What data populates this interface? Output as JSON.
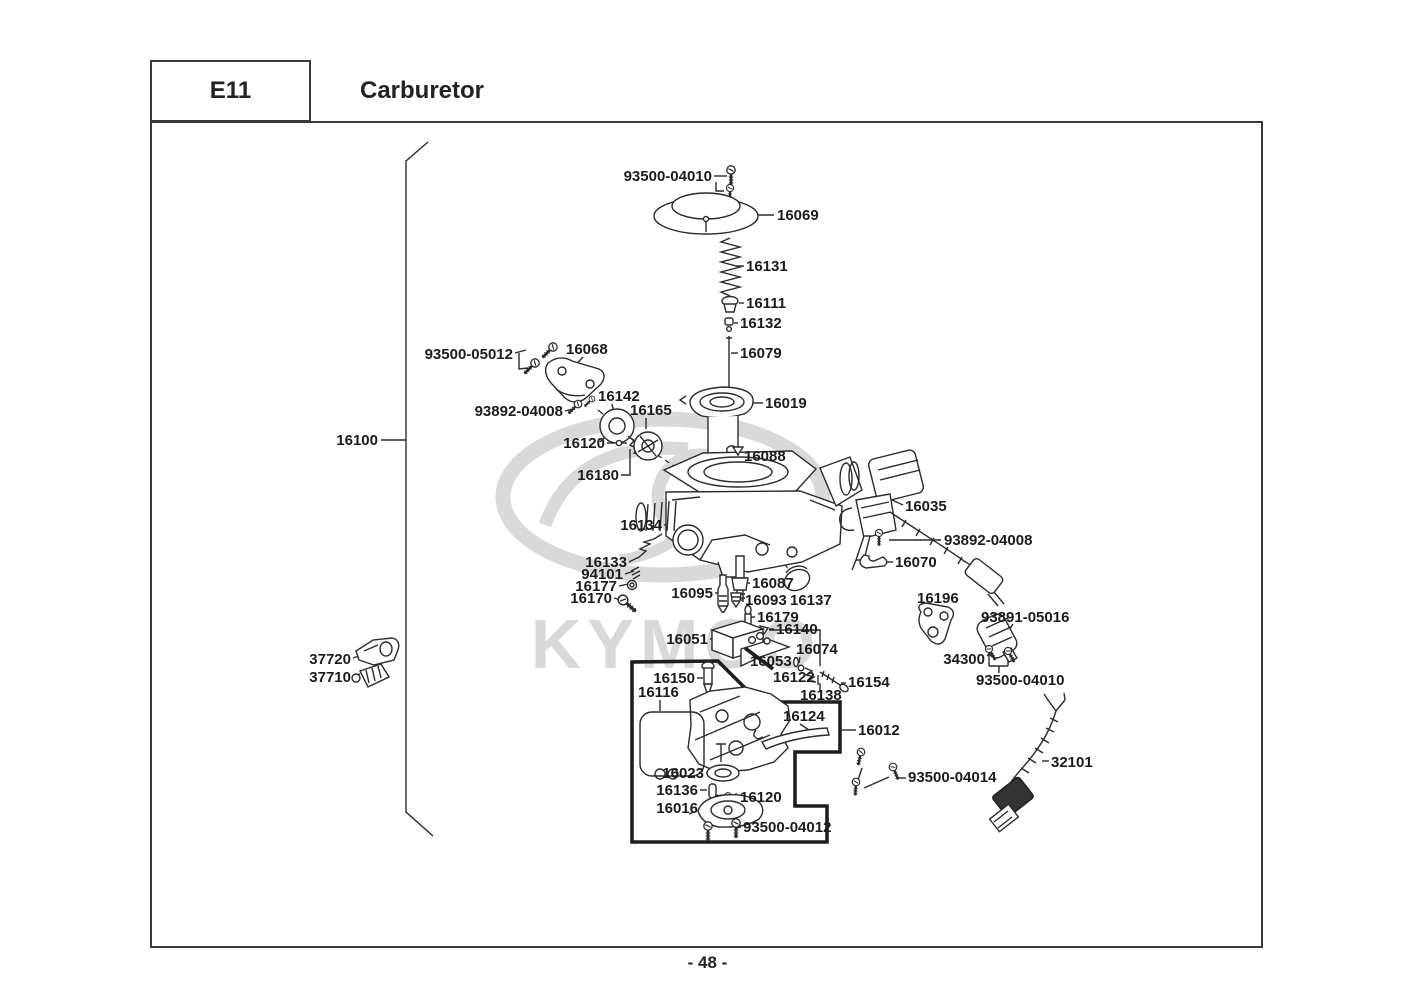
{
  "header": {
    "code": "E11",
    "title": "Carburetor"
  },
  "page_number": "- 48 -",
  "watermark": {
    "brand": "KYMCO"
  },
  "diagram": {
    "assembly_ref": "16100",
    "labels": [
      {
        "id": "93500-04010-top",
        "text": "93500-04010",
        "x": 712,
        "y": 181,
        "anchor": "end"
      },
      {
        "id": "16069",
        "text": "16069",
        "x": 777,
        "y": 220,
        "anchor": "start"
      },
      {
        "id": "16131",
        "text": "16131",
        "x": 746,
        "y": 271,
        "anchor": "start"
      },
      {
        "id": "16111",
        "text": "16111",
        "x": 746,
        "y": 308,
        "anchor": "start"
      },
      {
        "id": "16132",
        "text": "16132",
        "x": 740,
        "y": 328,
        "anchor": "start"
      },
      {
        "id": "16079",
        "text": "16079",
        "x": 740,
        "y": 358,
        "anchor": "start"
      },
      {
        "id": "93500-05012",
        "text": "93500-05012",
        "x": 513,
        "y": 359,
        "anchor": "end"
      },
      {
        "id": "16068",
        "text": "16068",
        "x": 566,
        "y": 354,
        "anchor": "start"
      },
      {
        "id": "16142",
        "text": "16142",
        "x": 598,
        "y": 401,
        "anchor": "start"
      },
      {
        "id": "93892-04008-left",
        "text": "93892-04008",
        "x": 563,
        "y": 416,
        "anchor": "end"
      },
      {
        "id": "16165",
        "text": "16165",
        "x": 630,
        "y": 415,
        "anchor": "start"
      },
      {
        "id": "16120-top",
        "text": "16120",
        "x": 605,
        "y": 448,
        "anchor": "end"
      },
      {
        "id": "16180",
        "text": "16180",
        "x": 619,
        "y": 480,
        "anchor": "end"
      },
      {
        "id": "16019",
        "text": "16019",
        "x": 765,
        "y": 408,
        "anchor": "start"
      },
      {
        "id": "16088",
        "text": "16088",
        "x": 744,
        "y": 461,
        "anchor": "start"
      },
      {
        "id": "16134",
        "text": "16134",
        "x": 662,
        "y": 530,
        "anchor": "end"
      },
      {
        "id": "16035",
        "text": "16035",
        "x": 905,
        "y": 511,
        "anchor": "start"
      },
      {
        "id": "93892-04008-right",
        "text": "93892-04008",
        "x": 944,
        "y": 545,
        "anchor": "start"
      },
      {
        "id": "16070",
        "text": "16070",
        "x": 895,
        "y": 567,
        "anchor": "start"
      },
      {
        "id": "16133",
        "text": "16133",
        "x": 627,
        "y": 567,
        "anchor": "end"
      },
      {
        "id": "94101",
        "text": "94101",
        "x": 623,
        "y": 579,
        "anchor": "end"
      },
      {
        "id": "16177",
        "text": "16177",
        "x": 617,
        "y": 591,
        "anchor": "end"
      },
      {
        "id": "16170",
        "text": "16170",
        "x": 612,
        "y": 603,
        "anchor": "end"
      },
      {
        "id": "16095",
        "text": "16095",
        "x": 713,
        "y": 598,
        "anchor": "end"
      },
      {
        "id": "16087",
        "text": "16087",
        "x": 752,
        "y": 588,
        "anchor": "start"
      },
      {
        "id": "16093",
        "text": "16093",
        "x": 745,
        "y": 605,
        "anchor": "start"
      },
      {
        "id": "16137",
        "text": "16137",
        "x": 790,
        "y": 605,
        "anchor": "start"
      },
      {
        "id": "16179",
        "text": "16179",
        "x": 757,
        "y": 622,
        "anchor": "start"
      },
      {
        "id": "16140",
        "text": "16140",
        "x": 776,
        "y": 634,
        "anchor": "start"
      },
      {
        "id": "16051",
        "text": "16051",
        "x": 708,
        "y": 644,
        "anchor": "end"
      },
      {
        "id": "16074",
        "text": "16074",
        "x": 796,
        "y": 654,
        "anchor": "start"
      },
      {
        "id": "16053",
        "text": "16053",
        "x": 750,
        "y": 666,
        "anchor": "start"
      },
      {
        "id": "16122",
        "text": "16122",
        "x": 773,
        "y": 682,
        "anchor": "start"
      },
      {
        "id": "16154",
        "text": "16154",
        "x": 848,
        "y": 687,
        "anchor": "start"
      },
      {
        "id": "16138",
        "text": "16138",
        "x": 800,
        "y": 700,
        "anchor": "start"
      },
      {
        "id": "16196",
        "text": "16196",
        "x": 917,
        "y": 603,
        "anchor": "start"
      },
      {
        "id": "93891-05016",
        "text": "93891-05016",
        "x": 981,
        "y": 622,
        "anchor": "start"
      },
      {
        "id": "34300",
        "text": "34300",
        "x": 985,
        "y": 664,
        "anchor": "end"
      },
      {
        "id": "93500-04010-bottom",
        "text": "93500-04010",
        "x": 976,
        "y": 685,
        "anchor": "start"
      },
      {
        "id": "37720",
        "text": "37720",
        "x": 351,
        "y": 664,
        "anchor": "end"
      },
      {
        "id": "37710",
        "text": "37710",
        "x": 351,
        "y": 682,
        "anchor": "end"
      },
      {
        "id": "16150",
        "text": "16150",
        "x": 695,
        "y": 683,
        "anchor": "end"
      },
      {
        "id": "16116",
        "text": "16116",
        "x": 638,
        "y": 697,
        "anchor": "start"
      },
      {
        "id": "16124",
        "text": "16124",
        "x": 783,
        "y": 721,
        "anchor": "start"
      },
      {
        "id": "16012",
        "text": "16012",
        "x": 858,
        "y": 735,
        "anchor": "start"
      },
      {
        "id": "16023",
        "text": "16023",
        "x": 704,
        "y": 778,
        "anchor": "end"
      },
      {
        "id": "16136",
        "text": "16136",
        "x": 698,
        "y": 795,
        "anchor": "end"
      },
      {
        "id": "16120-bottom",
        "text": "16120",
        "x": 740,
        "y": 802,
        "anchor": "start"
      },
      {
        "id": "16016",
        "text": "16016",
        "x": 698,
        "y": 813,
        "anchor": "end"
      },
      {
        "id": "93500-04012",
        "text": "93500-04012",
        "x": 743,
        "y": 832,
        "anchor": "start"
      },
      {
        "id": "93500-04014",
        "text": "93500-04014",
        "x": 908,
        "y": 782,
        "anchor": "start"
      },
      {
        "id": "32101",
        "text": "32101",
        "x": 1051,
        "y": 767,
        "anchor": "start"
      },
      {
        "id": "16100",
        "text": "16100",
        "x": 378,
        "y": 445,
        "anchor": "end"
      }
    ]
  }
}
